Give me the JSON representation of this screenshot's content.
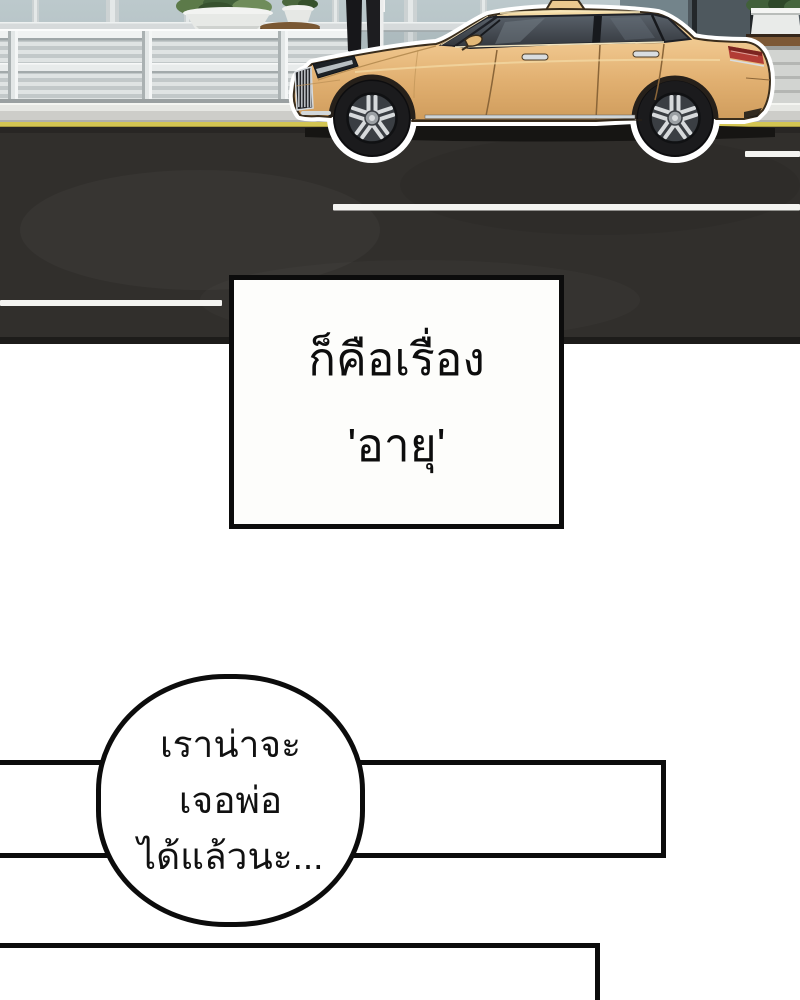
{
  "caption_box": {
    "lines": [
      "ก็คือเรื่อง",
      "'อายุ'"
    ]
  },
  "speech_bubble": {
    "lines": [
      "เราน่าจะ",
      "เจอพ่อ",
      "ได้แล้วนะ..."
    ]
  },
  "scene": {
    "objects": [
      "glass-building-facade",
      "guardrail-fence",
      "street-bench-slats",
      "picnic-table",
      "planter-pots-with-plants",
      "hedge-planter-box",
      "wooden-ledge-steps",
      "sidewalk-curb",
      "yellow-curb-line",
      "asphalt-road",
      "white-lane-markings",
      "tan-taxi-sedan",
      "taxi-roof-sign",
      "pedestrian-legs"
    ]
  },
  "colors": {
    "page_background": "#ffffff",
    "outline": "#0c0c0c",
    "car_body": "#e9c083",
    "car_body_highlight": "#f5dda8",
    "car_body_shadow": "#cf9c5c",
    "window_glass": "#3c4046",
    "tail_light_red": "#b23c35",
    "road": "#312f2c",
    "lane_marking": "#f4f4f1",
    "curb_yellow_line": "#d3c553",
    "glass_facade": "#b7c4c7",
    "rail_white": "#eef0f0",
    "plant_green": "#537046",
    "table_wood": "#7d5b34"
  }
}
